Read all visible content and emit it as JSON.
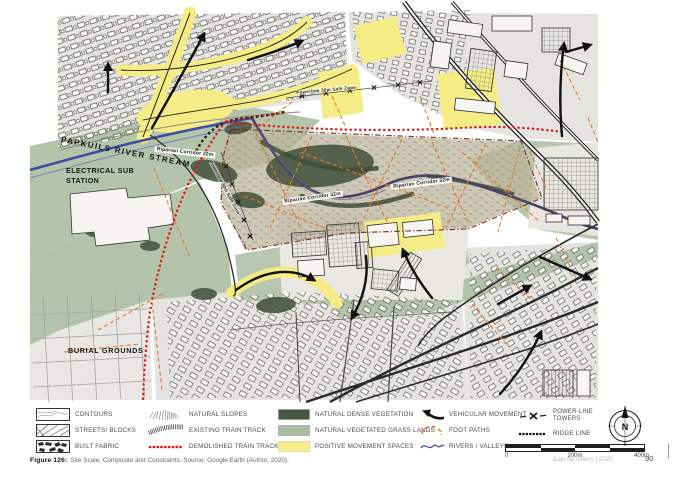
{
  "figure": {
    "caption_label": "Figure 126:",
    "caption_text": "Site Scale, Composite and Constraints. Source: Google Earth  (Author, 2020).",
    "credit": "Juan de Villiers | 2020",
    "page_number": "90"
  },
  "map_labels": {
    "river": "PAPKUILS RIVER STREAM",
    "substation_1": "ELECTRICAL SUB",
    "substation_2": "STATION",
    "burial": "BURIAL GROUNDS",
    "riparian_1": "Riparian Corridor 32m",
    "riparian_2": "Riparian Corridor 32m",
    "riparian_3": "Riparian Corridor 32m",
    "powerline_1": "Powerline 30m Safe Zone",
    "powerline_2": "Powerline 30m Safe Zone"
  },
  "legend": {
    "contours": "CONTOURS",
    "streets_blocks": "STREETS/ BLOCKS",
    "built_fabric": "BUILT FABRIC",
    "natural_slopes": "NATURAL SLOPES",
    "existing_train_track": "EXISTING TRAIN TRACK",
    "demolished_train_track": "DEMOLISHED TRAIN TRACK",
    "natural_dense_vegetation": "NATURAL DENSE VEGETATION",
    "natural_vegetated_grass_lands": "NATURAL VEGETATED GRASS LANDS",
    "positive_movement_spaces": "POSITIVE MOVEMENT SPACES",
    "vehicular_movement": "VEHICULAR MOVEMENT",
    "foot_paths": "FOOT PATHS",
    "rivers_valleys": "RIVERS / VALLEYS",
    "power_line_towers": "POWER-LINE TOWERS",
    "ridge_line": "RIDGE LINE"
  },
  "scale_bar": {
    "zero": "0",
    "mid": "200m",
    "end": "400m"
  },
  "compass": {
    "label": "N"
  },
  "colors": {
    "dense_vegetation": "#4b5942",
    "grass_lands": "#b0c1a6",
    "positive_movement": "#f6ec86",
    "foot_path_orange": "#e8772e",
    "demolished_red": "#e31515",
    "river_blue": "#3c4da6",
    "stream_purple": "#474169",
    "boundary_dark_red": "#7a241a"
  }
}
